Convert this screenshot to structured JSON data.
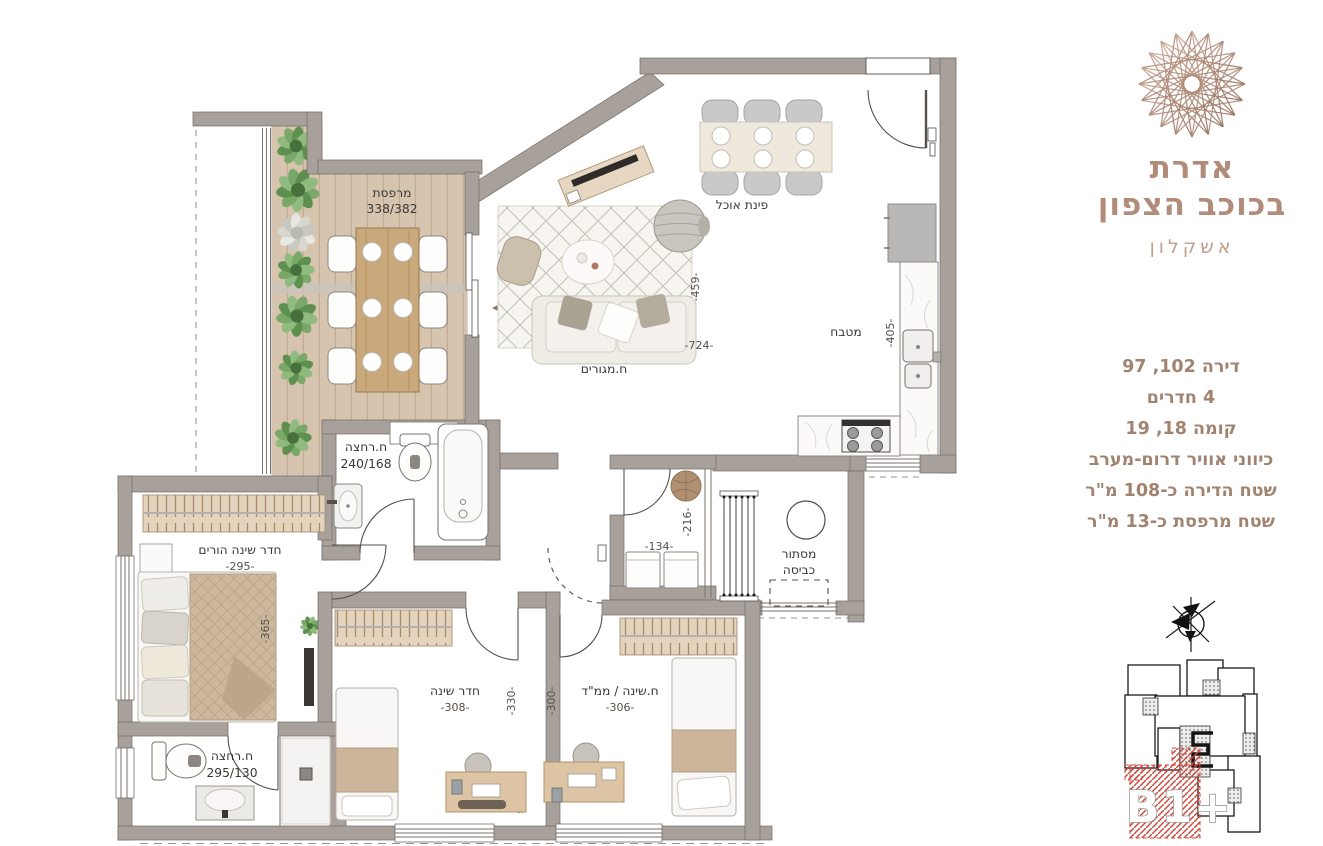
{
  "project": {
    "name_line1": "אדרת",
    "name_line2": "בכוכב הצפון",
    "city": "אשקלון"
  },
  "apartment_details": {
    "lines": [
      "דירה 102, 97",
      "4 חדרים",
      "קומה 18, 19",
      "כיווני אוויר דרום-מערב",
      "שטח הדירה כ-108 מ\"ר",
      "שטח מרפסת כ-13 מ\"ר"
    ]
  },
  "rooms": {
    "balcony": {
      "label": "מרפסת",
      "size": "338/382"
    },
    "dining": {
      "label": "פינת אוכל"
    },
    "living": {
      "label": "ח.מגורים",
      "width": "-724-",
      "height": "-459-"
    },
    "kitchen": {
      "label": "מטבח",
      "depth": "-405-"
    },
    "bathroom1": {
      "label": "ח.רחצה",
      "size": "240/168"
    },
    "master_bedroom": {
      "label": "חדר שינה הורים",
      "width": "-295-",
      "height": "-365-"
    },
    "bathroom2": {
      "label": "ח.רחצה",
      "size": "295/130"
    },
    "bedroom": {
      "label": "חדר שינה",
      "width": "-308-",
      "height": "-330-"
    },
    "safe_room": {
      "label": "ח.שינה / ממ\"ד",
      "width": "-306-",
      "height": "-300-"
    },
    "laundry_niche": {
      "width": "-134-",
      "height": "-216-"
    },
    "laundry_screen": {
      "label_line1": "מסתור",
      "label_line2": "כביסה"
    }
  },
  "keyplan": {
    "unit_label": "B1+"
  },
  "colors": {
    "bronze": "#b18c7a",
    "text_brown": "#a18370",
    "wall": "#a8a19b",
    "hatch_red": "#cf4a3e"
  }
}
